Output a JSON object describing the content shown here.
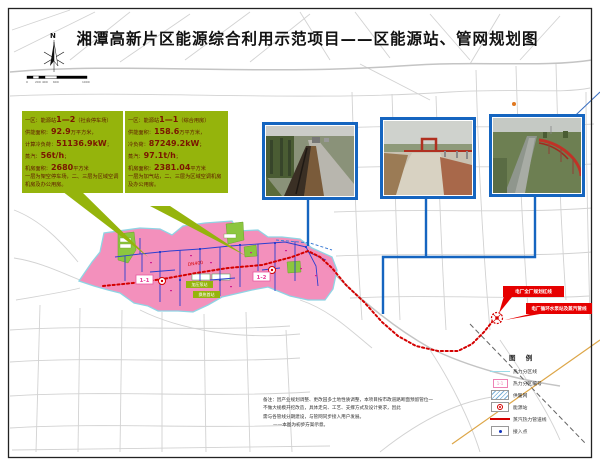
{
  "title": "湘潭高新片区能源综合利用示范项目——区能源站、管网规划图",
  "compass": {
    "label": "N"
  },
  "scalebar": {
    "labels": [
      "0",
      "200",
      "400",
      "600",
      "1000"
    ]
  },
  "info_boxes": [
    {
      "rows": [
        {
          "pre": "一区：能源站",
          "num": "1—2",
          "post": "（社会停车场）"
        },
        {
          "pre": "供能面积：",
          "num": "92.9",
          "post": "万平方米，"
        },
        {
          "pre": "计算冷负荷：",
          "num": "51136.9kW",
          "post": "；"
        },
        {
          "pre": "蒸汽：",
          "num": "56t/h",
          "post": "；"
        },
        {
          "pre": "机房面积：",
          "num": "2680",
          "post": "平方米"
        },
        {
          "pre": "一层为架空停车场，二、三层为区域空调机房及办公用房。",
          "num": "",
          "post": ""
        }
      ]
    },
    {
      "rows": [
        {
          "pre": "一区：能源站",
          "num": "1—1",
          "post": "（综合用房）"
        },
        {
          "pre": "供能面积：",
          "num": "158.6",
          "post": "万平方米，"
        },
        {
          "pre": "冷负荷：",
          "num": "87249.2kW",
          "post": "；"
        },
        {
          "pre": "蒸汽：",
          "num": "97.1t/h",
          "post": "；"
        },
        {
          "pre": "机房面积：",
          "num": "2381.04",
          "post": "平方米"
        },
        {
          "pre": "一层为加气站，二、三层为区域空调机房及办公用房。",
          "num": "",
          "post": ""
        }
      ]
    }
  ],
  "map": {
    "zone_labels": [
      "1-1",
      "1-2"
    ],
    "pipe_label": "DN400",
    "station_chips": [
      "加压泵站",
      "换热首站"
    ],
    "red_labels": [
      "电厂全厂规划红线",
      "电厂循环水泵站及蒸汽管线"
    ]
  },
  "legend": {
    "title": "图 例",
    "items": [
      {
        "label": "热力分区线"
      },
      {
        "label": "热力分区编号",
        "swatch_text": "1-1"
      },
      {
        "label": "供暖网"
      },
      {
        "label": "能源站"
      },
      {
        "label": "蒸汽热力管道线"
      },
      {
        "label": "接入点"
      }
    ]
  },
  "notes": {
    "lines": [
      "备注：因产业规划调整、更改园多土地性质调整，本项目按市政道路断面预留管位一",
      "不做大规模开挖改造，具体走向、工艺、支撑方式及设计要求，因此",
      "需与各管线分期建设，与管网同步接入用户发展。",
      "——本图为初步方案示意。"
    ]
  },
  "colors": {
    "callout_green": "#95b40c",
    "zone_pink": "#f28ab8",
    "steam_red": "#d40000",
    "photo_border": "#1565c0",
    "zone_line_cyan": "#8fd4e4"
  }
}
